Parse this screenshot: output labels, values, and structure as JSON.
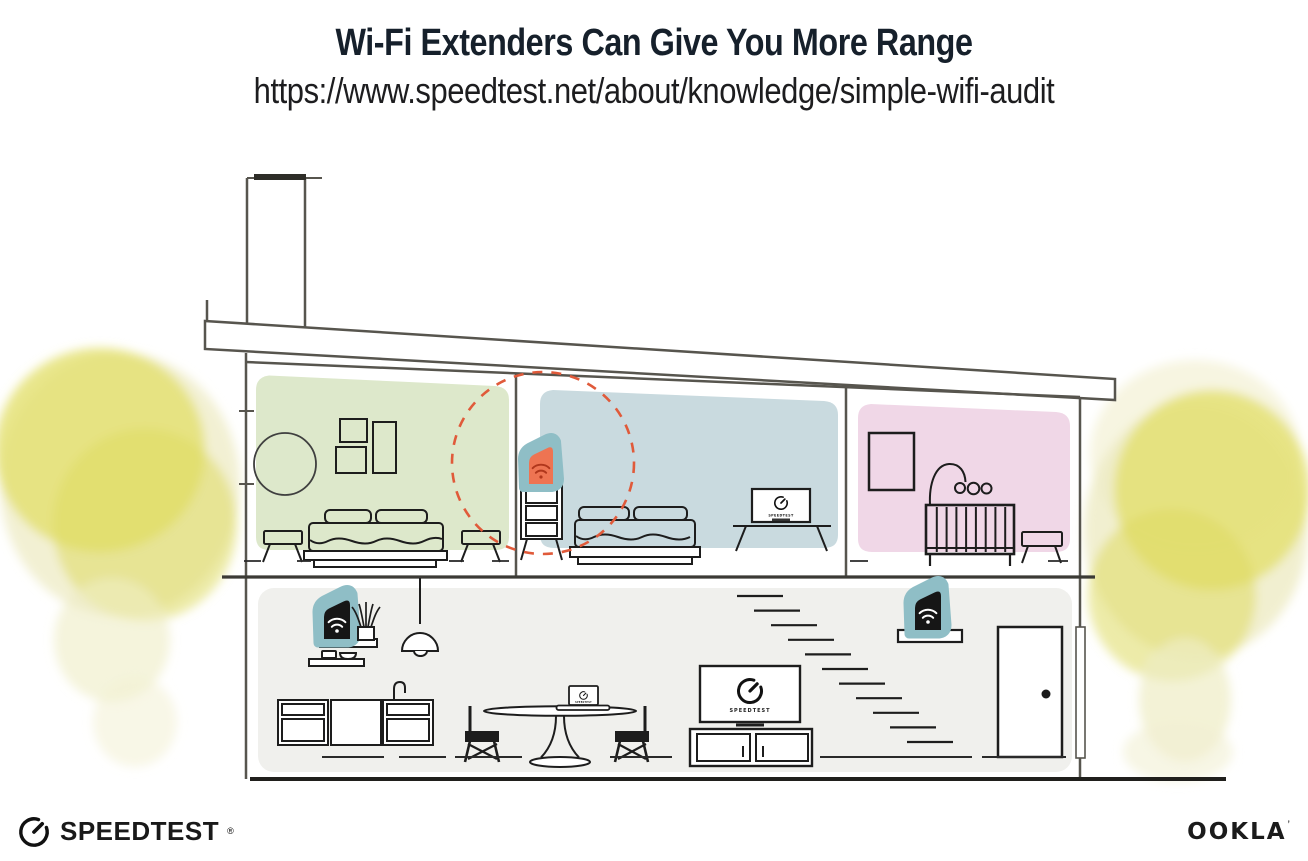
{
  "header": {
    "title": "Wi-Fi Extenders Can Give You More Range",
    "subtitle_url": "https://www.speedtest.net/about/knowledge/simple-wifi-audit"
  },
  "footer": {
    "speedtest_label": "SPEEDTEST",
    "speedtest_trademark": "®",
    "ookla_label": "OOKLA",
    "ookla_trademark": "’"
  },
  "illustration": {
    "screen_label": "SPEEDTEST",
    "icons": {
      "wifi": "wifi-arcs",
      "speedometer": "gauge-dial-with-needle"
    },
    "colors": {
      "room_green": "#dde8cb",
      "room_blue": "#c9dadf",
      "room_pink": "#f0d7e7",
      "lower_floor_gray": "#f0f0ed",
      "extender_teal": "#8fbec6",
      "extender_orange": "#ee7452",
      "wifi_dark_red": "#b0371c",
      "device_black": "#161616",
      "highlight_red_dashed": "#e05a3a",
      "foliage_yellow": "#e3e06e",
      "structure_line": "#57554e",
      "ink": "#1d1d1d"
    }
  }
}
